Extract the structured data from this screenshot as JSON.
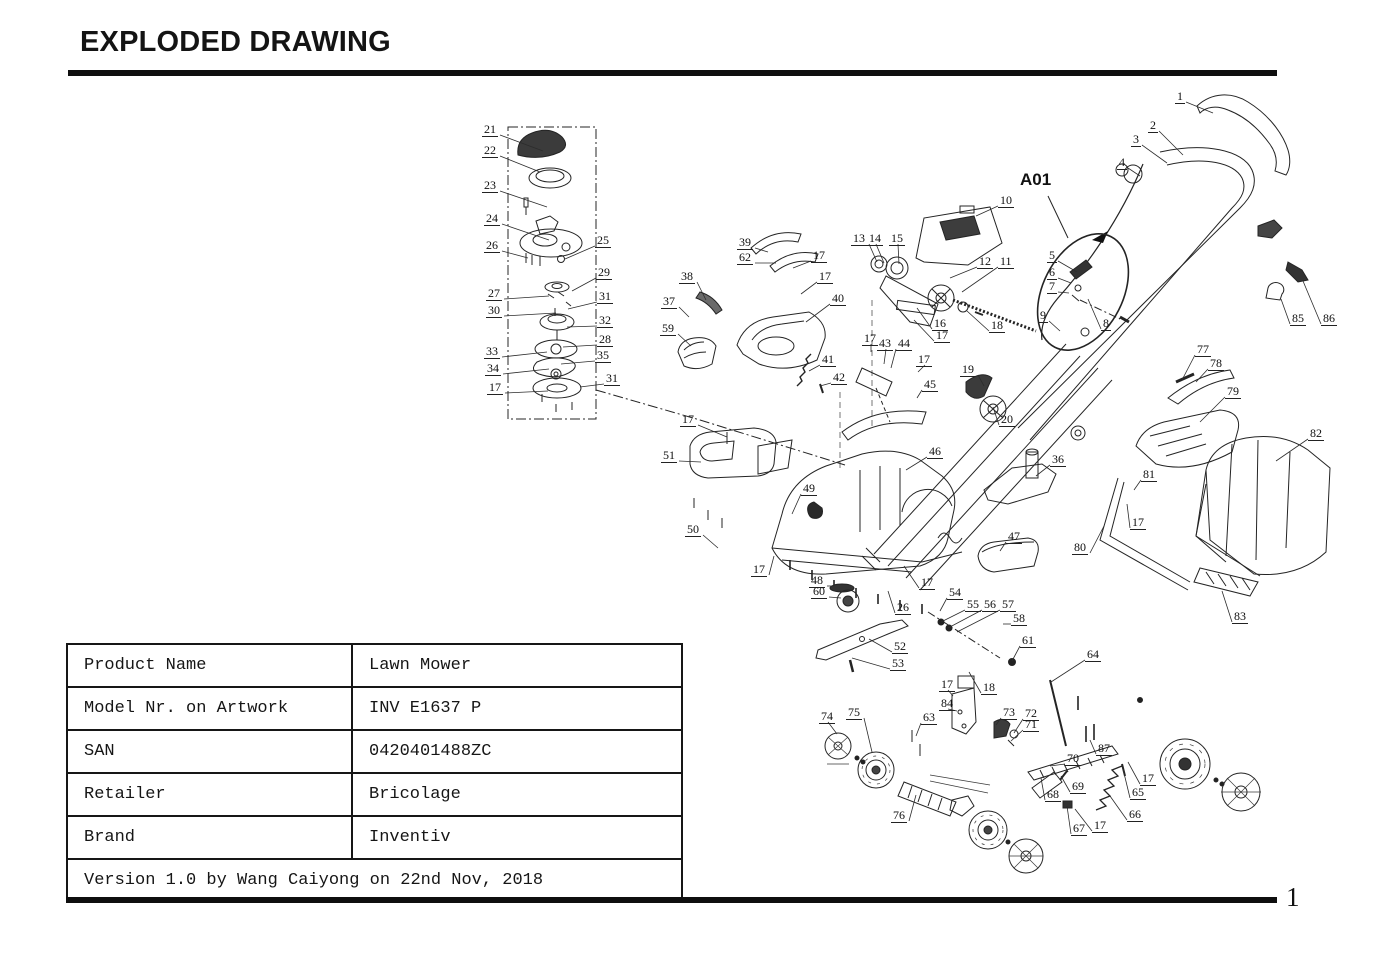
{
  "page": {
    "title": "EXPLODED DRAWING",
    "page_number": "1"
  },
  "drawing": {
    "detail_label": "A01",
    "callouts": [
      [
        "21",
        482,
        123,
        543,
        151
      ],
      [
        "22",
        482,
        144,
        540,
        172
      ],
      [
        "23",
        482,
        179,
        547,
        207
      ],
      [
        "24",
        484,
        212,
        549,
        240
      ],
      [
        "26",
        484,
        239,
        528,
        258
      ],
      [
        "25",
        595,
        234,
        565,
        259
      ],
      [
        "27",
        486,
        287,
        549,
        296
      ],
      [
        "29",
        596,
        266,
        572,
        291
      ],
      [
        "30",
        486,
        304,
        556,
        313
      ],
      [
        "31",
        597,
        290,
        568,
        309
      ],
      [
        "32",
        597,
        314,
        567,
        327
      ],
      [
        "33",
        484,
        345,
        547,
        352
      ],
      [
        "28",
        597,
        333,
        563,
        347
      ],
      [
        "34",
        485,
        362,
        549,
        369
      ],
      [
        "35",
        595,
        349,
        561,
        364
      ],
      [
        "17",
        487,
        381,
        548,
        391
      ],
      [
        "31",
        604,
        372,
        580,
        387
      ],
      [
        "39",
        737,
        236,
        768,
        252
      ],
      [
        "62",
        737,
        251,
        776,
        263
      ],
      [
        "17",
        811,
        249,
        793,
        268
      ],
      [
        "38",
        679,
        270,
        706,
        300
      ],
      [
        "37",
        661,
        295,
        689,
        317
      ],
      [
        "59",
        660,
        322,
        691,
        346
      ],
      [
        "17",
        817,
        270,
        801,
        294
      ],
      [
        "40",
        830,
        292,
        806,
        322
      ],
      [
        "41",
        820,
        353,
        809,
        371
      ],
      [
        "42",
        831,
        371,
        820,
        386
      ],
      [
        "13",
        851,
        232,
        877,
        262
      ],
      [
        "14",
        867,
        232,
        884,
        263
      ],
      [
        "15",
        889,
        232,
        899,
        264
      ],
      [
        "10",
        998,
        194,
        976,
        216
      ],
      [
        "12",
        977,
        255,
        950,
        278
      ],
      [
        "11",
        998,
        255,
        962,
        292
      ],
      [
        "16",
        932,
        317,
        917,
        308
      ],
      [
        "17",
        934,
        329,
        914,
        320
      ],
      [
        "18",
        989,
        319,
        967,
        311
      ],
      [
        "1",
        1175,
        90,
        1213,
        113
      ],
      [
        "2",
        1148,
        119,
        1183,
        155
      ],
      [
        "3",
        1131,
        133,
        1167,
        163
      ],
      [
        "4",
        1117,
        156,
        1140,
        176
      ],
      [
        "5",
        1047,
        249,
        1077,
        272
      ],
      [
        "6",
        1047,
        266,
        1071,
        283
      ],
      [
        "7",
        1047,
        280,
        1069,
        293
      ],
      [
        "8",
        1101,
        317,
        1088,
        299
      ],
      [
        "9",
        1038,
        309,
        1060,
        331
      ],
      [
        "85",
        1290,
        312,
        1281,
        299
      ],
      [
        "86",
        1321,
        312,
        1303,
        281
      ],
      [
        "19",
        960,
        363,
        984,
        386
      ],
      [
        "20",
        999,
        413,
        993,
        407
      ],
      [
        "43",
        877,
        337,
        884,
        364
      ],
      [
        "44",
        896,
        337,
        891,
        368
      ],
      [
        "17",
        862,
        332,
        871,
        352
      ],
      [
        "17",
        916,
        353,
        918,
        372
      ],
      [
        "45",
        922,
        378,
        917,
        398
      ],
      [
        "77",
        1195,
        343,
        1182,
        380
      ],
      [
        "78",
        1208,
        357,
        1196,
        382
      ],
      [
        "79",
        1225,
        385,
        1200,
        422
      ],
      [
        "82",
        1308,
        427,
        1276,
        461
      ],
      [
        "81",
        1141,
        468,
        1134,
        490
      ],
      [
        "17",
        1130,
        516,
        1127,
        504
      ],
      [
        "80",
        1072,
        541,
        1104,
        526
      ],
      [
        "83",
        1232,
        610,
        1222,
        591
      ],
      [
        "17",
        680,
        413,
        727,
        437
      ],
      [
        "51",
        661,
        449,
        701,
        462
      ],
      [
        "50",
        685,
        523,
        718,
        548
      ],
      [
        "49",
        801,
        482,
        792,
        514
      ],
      [
        "46",
        927,
        445,
        906,
        470
      ],
      [
        "36",
        1050,
        453,
        1036,
        476
      ],
      [
        "47",
        1006,
        530,
        1000,
        551
      ],
      [
        "17",
        751,
        563,
        774,
        556
      ],
      [
        "48",
        809,
        574,
        834,
        586
      ],
      [
        "60",
        811,
        585,
        841,
        598
      ],
      [
        "26",
        895,
        601,
        888,
        591
      ],
      [
        "17",
        919,
        576,
        904,
        566
      ],
      [
        "52",
        892,
        640,
        869,
        639
      ],
      [
        "53",
        890,
        657,
        852,
        658
      ],
      [
        "54",
        947,
        586,
        940,
        611
      ],
      [
        "55",
        965,
        598,
        941,
        622
      ],
      [
        "56",
        982,
        598,
        948,
        628
      ],
      [
        "57",
        1000,
        598,
        957,
        632
      ],
      [
        "58",
        1011,
        612,
        1003,
        624
      ],
      [
        "61",
        1020,
        634,
        1012,
        661
      ],
      [
        "64",
        1085,
        648,
        1051,
        682
      ],
      [
        "17",
        939,
        678,
        953,
        696
      ],
      [
        "18",
        981,
        681,
        969,
        672
      ],
      [
        "84",
        939,
        697,
        957,
        711
      ],
      [
        "74",
        819,
        710,
        837,
        734
      ],
      [
        "75",
        846,
        706,
        872,
        752
      ],
      [
        "63",
        921,
        711,
        916,
        736
      ],
      [
        "73",
        1001,
        706,
        996,
        725
      ],
      [
        "72",
        1023,
        707,
        1014,
        733
      ],
      [
        "71",
        1023,
        718,
        1011,
        741
      ],
      [
        "87",
        1096,
        742,
        1090,
        740
      ],
      [
        "70",
        1065,
        752,
        1050,
        766
      ],
      [
        "69",
        1070,
        780,
        1061,
        776
      ],
      [
        "68",
        1045,
        788,
        1041,
        778
      ],
      [
        "65",
        1130,
        786,
        1123,
        769
      ],
      [
        "17",
        1140,
        772,
        1128,
        762
      ],
      [
        "66",
        1127,
        808,
        1110,
        796
      ],
      [
        "67",
        1071,
        822,
        1067,
        806
      ],
      [
        "17",
        1092,
        819,
        1075,
        809
      ],
      [
        "76",
        891,
        809,
        916,
        795
      ]
    ]
  },
  "info_table": {
    "rows": [
      {
        "label": "Product Name",
        "value": "Lawn Mower"
      },
      {
        "label": "Model Nr. on Artwork",
        "value": "INV E1637 P"
      },
      {
        "label": "SAN",
        "value": "0420401488ZC"
      },
      {
        "label": "Retailer",
        "value": "Bricolage"
      },
      {
        "label": "Brand",
        "value": "Inventiv"
      }
    ],
    "footer": "Version 1.0 by Wang Caiyong on 22nd Nov, 2018"
  }
}
